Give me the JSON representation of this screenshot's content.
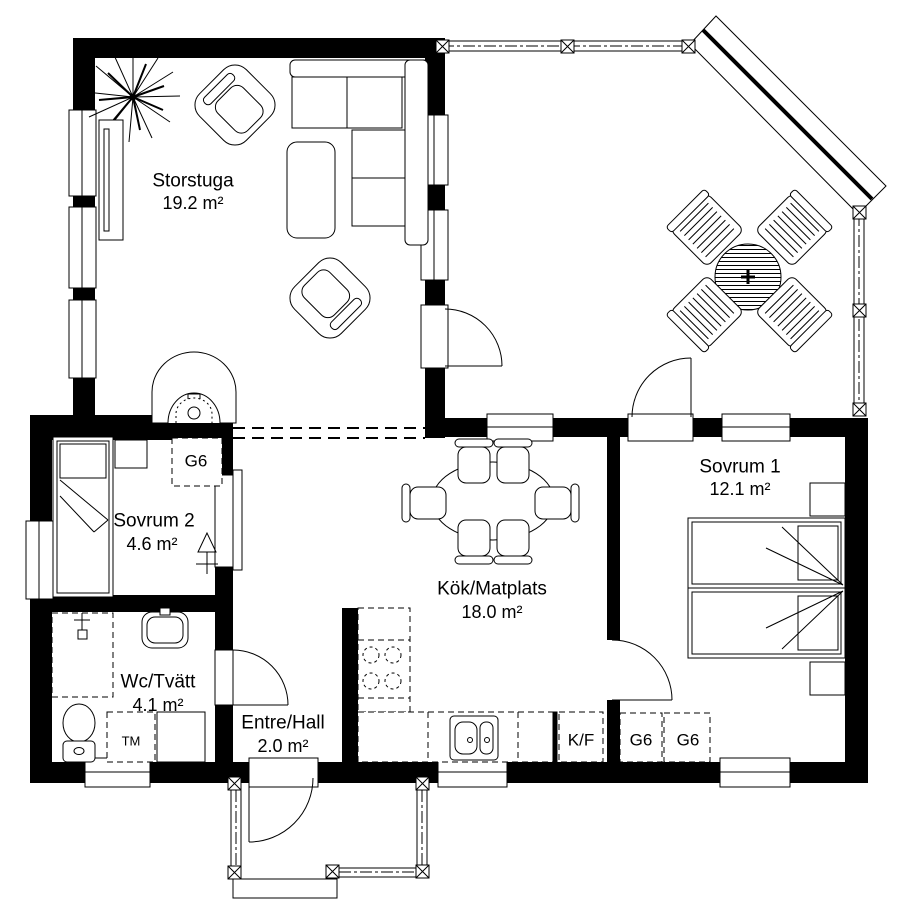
{
  "page": {
    "background": "#ffffff",
    "line_color": "#000000",
    "type": "architectural floor plan"
  },
  "rooms": [
    {
      "key": "storstuga",
      "name": "Storstuga",
      "area": "19.2 m²"
    },
    {
      "key": "sovrum2",
      "name": "Sovrum 2",
      "area": "4.6 m²"
    },
    {
      "key": "kok_matplats",
      "name": "Kök/Matplats",
      "area": "18.0 m²"
    },
    {
      "key": "sovrum1",
      "name": "Sovrum 1",
      "area": "12.1 m²"
    },
    {
      "key": "wc_tvatt",
      "name": "Wc/Tvätt",
      "area": "4.1 m²"
    },
    {
      "key": "entre_hall",
      "name": "Entre/Hall",
      "area": "2.0 m²"
    }
  ],
  "fixtures": {
    "wardrobe_sovrum2": "G6",
    "wardrobe_hall_1": "G6",
    "wardrobe_hall_2": "G6",
    "fridge_freezer": "K/F",
    "washing_machine": "TM"
  }
}
